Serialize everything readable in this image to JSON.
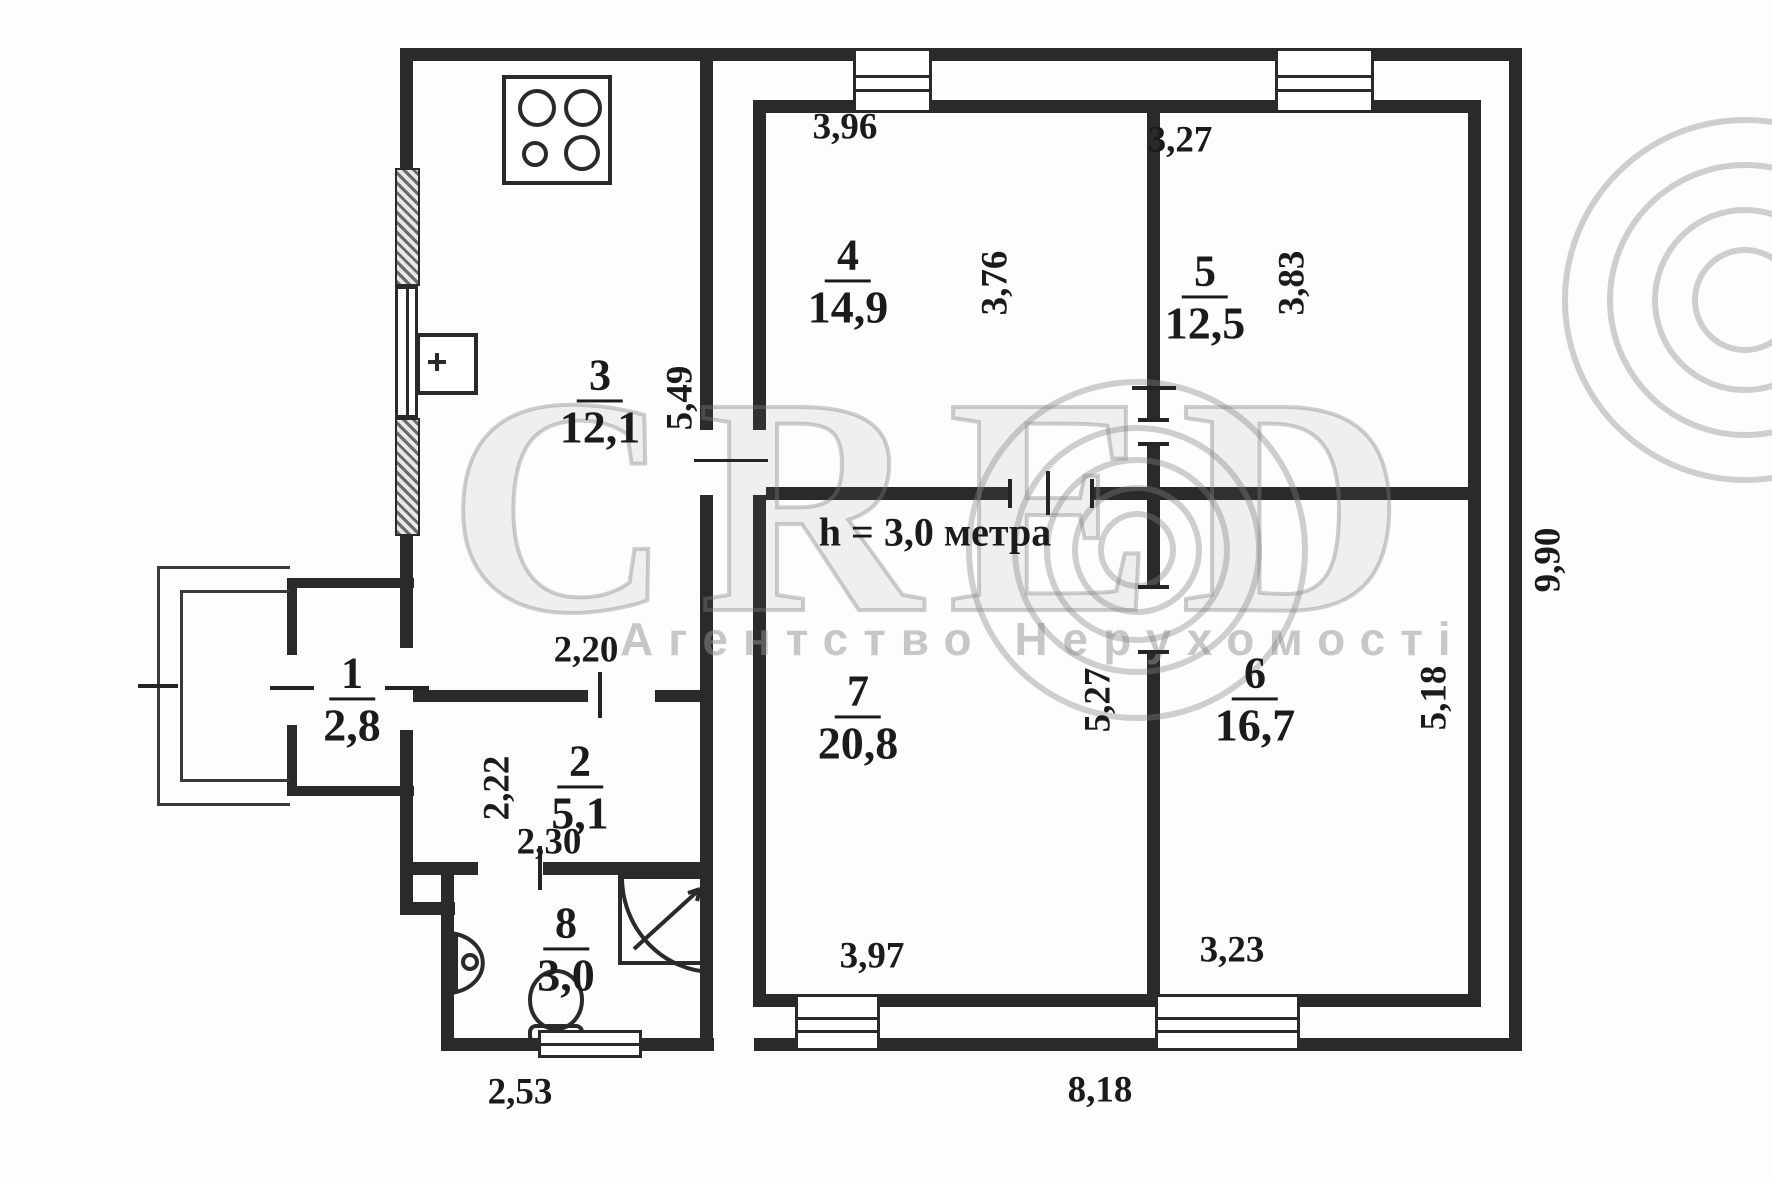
{
  "watermark": {
    "brand": "CRED",
    "subtitle": "Агентство Нерухомості"
  },
  "note": {
    "ceiling_height": "h = 3,0 метра"
  },
  "rooms": {
    "r1": {
      "number": "1",
      "area": "2,8"
    },
    "r2": {
      "number": "2",
      "area": "5,1"
    },
    "r3": {
      "number": "3",
      "area": "12,1"
    },
    "r4": {
      "number": "4",
      "area": "14,9"
    },
    "r5": {
      "number": "5",
      "area": "12,5"
    },
    "r6": {
      "number": "6",
      "area": "16,7"
    },
    "r7": {
      "number": "7",
      "area": "20,8"
    },
    "r8": {
      "number": "8",
      "area": "3,0"
    }
  },
  "dimensions": {
    "room4_top": "3,96",
    "room5_top": "3,27",
    "room4_right": "3,76",
    "room5_right": "3,83",
    "kitchen_height": "5,49",
    "kitchen_passage": "2,20",
    "room2_height": "2,22",
    "room2_width": "2,30",
    "room7_right": "5,27",
    "room6_right": "5,18",
    "room7_bottom": "3,97",
    "room6_bottom": "3,23",
    "bottom_total": "8,18",
    "right_total": "9,90",
    "bottom_left": "2,53"
  }
}
